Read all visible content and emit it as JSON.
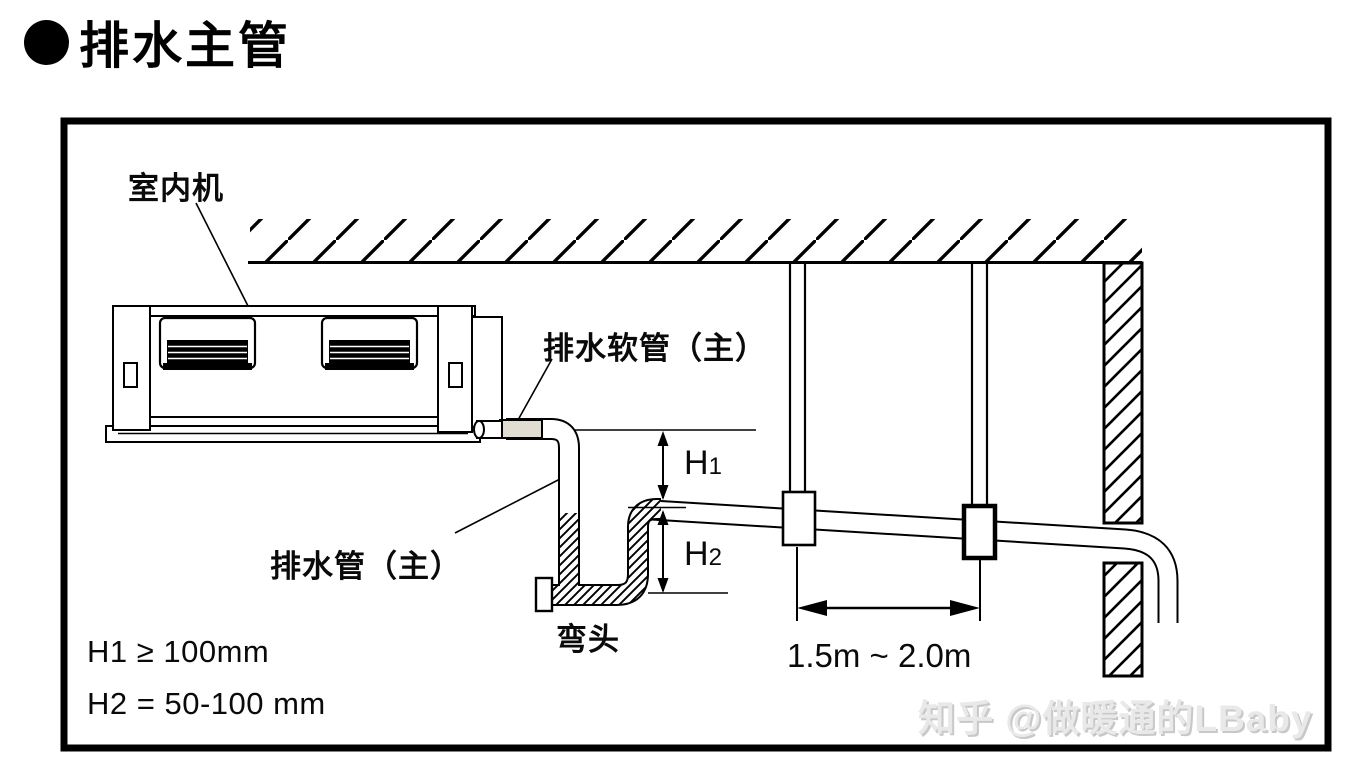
{
  "title": {
    "text": "排水主管"
  },
  "diagram": {
    "labels": {
      "indoor_unit": "室内机",
      "drain_hose_main": "排水软管（主）",
      "drain_pipe_main": "排水管（主）",
      "elbow": "弯头",
      "h1": {
        "base": "H",
        "sub": "1"
      },
      "h2": {
        "base": "H",
        "sub": "2"
      },
      "hanger_spacing": "1.5m ~ 2.0m"
    },
    "notes": {
      "h1_rule": "H1 ≥ 100mm",
      "h2_rule": "H2 = 50-100 mm"
    },
    "colors": {
      "hose": "#e2ddd3",
      "line": "#000000"
    }
  },
  "watermark": {
    "text": "知乎 @做暖通的LBaby"
  }
}
